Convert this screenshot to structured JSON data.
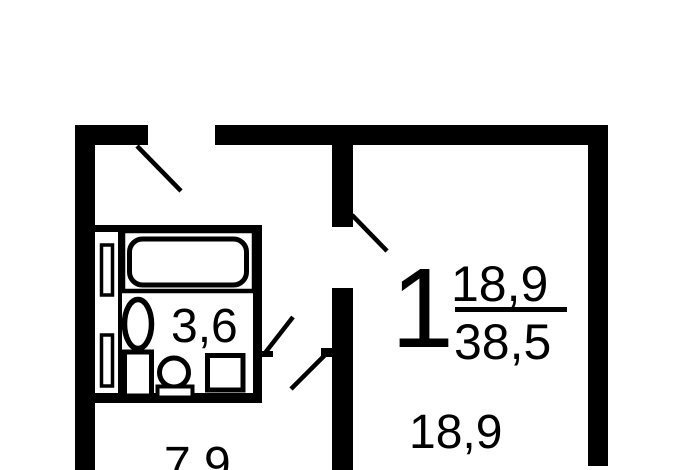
{
  "plan": {
    "background_color": "#ffffff",
    "wall_color": "#000000",
    "room1": {
      "number": "1",
      "living_area": "18,9",
      "total_area": "38,5",
      "area_label": "18,9"
    },
    "bathroom": {
      "area_label": "3,6"
    },
    "kitchen": {
      "area_label": "7,9"
    },
    "fixtures": [
      {
        "name": "bathtub"
      },
      {
        "name": "sink"
      },
      {
        "name": "toilet"
      },
      {
        "name": "washing-machine"
      },
      {
        "name": "ventilation-shaft"
      }
    ]
  }
}
